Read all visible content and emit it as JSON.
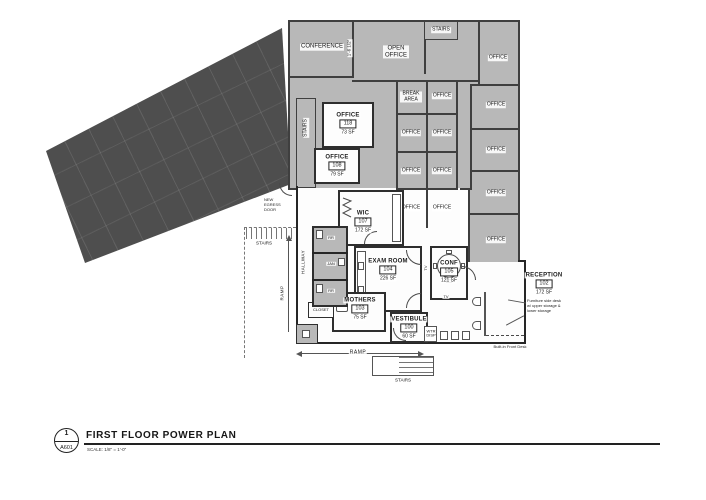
{
  "title_block": {
    "detail_number": "1",
    "sheet": "A601",
    "title": "FIRST FLOOR POWER PLAN",
    "scale_label": "SCALE:  1/8\" = 1'-0\""
  },
  "labels": {
    "office": "OFFICE",
    "conference": "CONFERENCE",
    "open_office": "OPEN OFFICE",
    "stairs": "STAIRS",
    "break_area": "BREAK AREA",
    "hallway": "HALLWAY",
    "ramp": "RAMP",
    "closet": "CLOSET",
    "rr": "RR",
    "jan": "JAN",
    "tv": "TV",
    "wtr_disp": "WTR DISP"
  },
  "rooms": {
    "office_118": {
      "name": "OFFICE",
      "number": "118",
      "area": "73 SF"
    },
    "office_108": {
      "name": "OFFICE",
      "number": "108",
      "area": "79 SF"
    },
    "wic": {
      "name": "WIC",
      "number": "107",
      "area": "172 SF"
    },
    "exam": {
      "name": "EXAM ROOM",
      "number": "104",
      "area": "226 SF"
    },
    "conf": {
      "name": "CONF",
      "number": "105",
      "area": "121 SF"
    },
    "mothers": {
      "name": "MOTHERS",
      "number": "103",
      "area": "75 SF"
    },
    "vestibule": {
      "name": "VESTIBULE",
      "number": "100",
      "area": "60 SF"
    },
    "reception": {
      "name": "RECEPTION",
      "number": "102",
      "area": "172 SF"
    }
  },
  "annotations": {
    "new_egress_door": "NEW EGRESS DOOR",
    "furniture_note": "Furniture side desk w/ upper storage & lower storage",
    "front_desk_note": "Built-in Front Desk",
    "conf_dim": "1'-6 1/2\""
  },
  "colors": {
    "existing_fill": "#4e4e4e",
    "shell_fill": "#b8b8b8",
    "wall": "#3f3f3f",
    "paper": "#ffffff"
  }
}
